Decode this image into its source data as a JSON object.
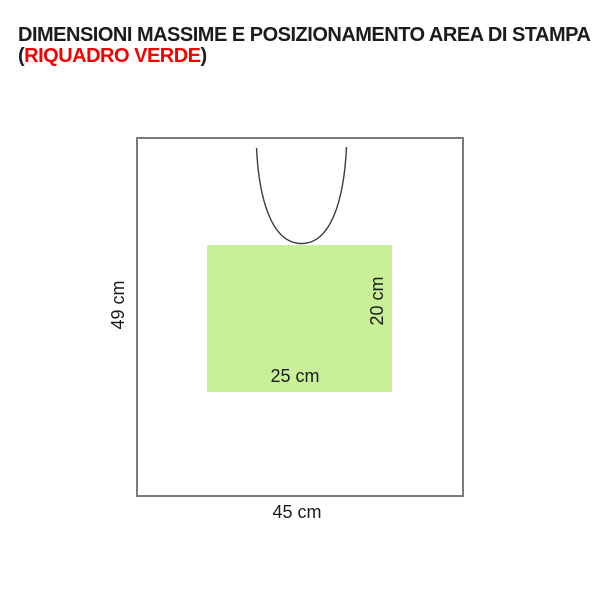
{
  "title": {
    "line1": "DIMENSIONI MASSIME E POSIZIONAMENTO AREA DI STAMPA",
    "line2_open": "(",
    "line2_text": "RIQUADRO VERDE",
    "line2_close": ")"
  },
  "diagram": {
    "outer": {
      "width_label": "45 cm",
      "height_label": "49 cm"
    },
    "print_area": {
      "width_label": "25 cm",
      "height_label": "20 cm"
    }
  },
  "colors": {
    "text_black": "#1c1c1c",
    "highlight_red": "#f70000",
    "outline_gray": "#7a7a7a",
    "neckline_gray": "#3c3c3c",
    "print_area_green": "#c8f096"
  }
}
